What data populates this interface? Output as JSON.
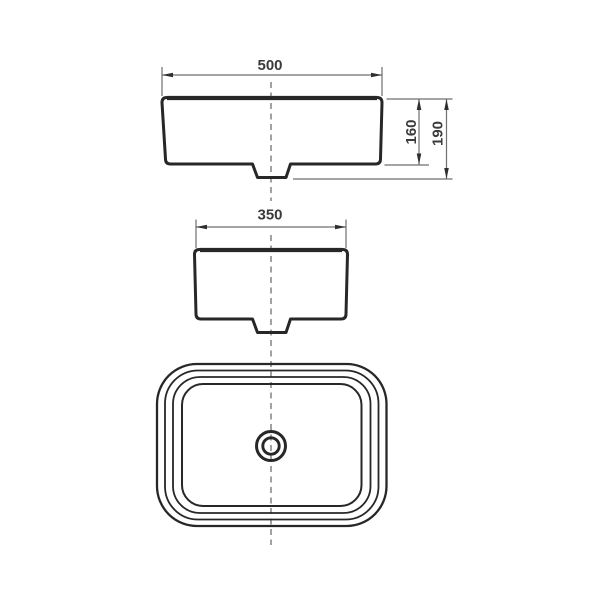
{
  "drawing": {
    "dimensions": {
      "front_width": "500",
      "side_depth": "350",
      "basin_height": "160",
      "overall_height": "190"
    },
    "colors": {
      "background": "#ffffff",
      "outline": "#272727",
      "dimension_line": "#6f6f6f",
      "arrow": "#2e2e2e",
      "text": "#3b3b3b",
      "centerline": "#7a7a7a"
    }
  }
}
